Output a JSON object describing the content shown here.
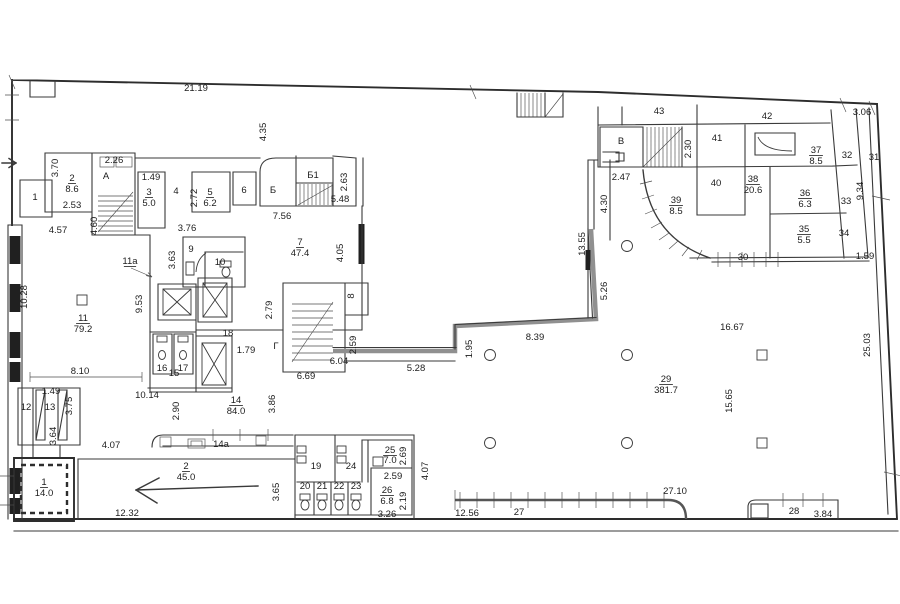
{
  "plan": {
    "type": "architectural-floor-plan",
    "background": "#ffffff",
    "line_color": "#3a3a3a",
    "thick_wall_color": "#909090",
    "labels": [
      {
        "id": "dim-21-19",
        "text": "21.19",
        "x": 196,
        "y": 91,
        "size": 11
      },
      {
        "id": "dim-4-35",
        "text": "4.35",
        "x": 266,
        "y": 132,
        "rot": -90
      },
      {
        "id": "dim-3-06",
        "text": "3.06",
        "x": 862,
        "y": 115
      },
      {
        "id": "dim-3-70",
        "text": "3.70",
        "x": 58,
        "y": 168,
        "rot": -90
      },
      {
        "id": "dim-2-26",
        "text": "2.26",
        "x": 114,
        "y": 163
      },
      {
        "id": "dim-1-49-a",
        "text": "1.49",
        "x": 151,
        "y": 180
      },
      {
        "id": "dim-2-53",
        "text": "2.53",
        "x": 72,
        "y": 208
      },
      {
        "id": "dim-4-60",
        "text": "4.60",
        "x": 97,
        "y": 226,
        "rot": -90
      },
      {
        "id": "dim-2-72",
        "text": "2.72",
        "x": 197,
        "y": 198,
        "rot": -90
      },
      {
        "id": "dim-3-76",
        "text": "3.76",
        "x": 187,
        "y": 231
      },
      {
        "id": "dim-4-57",
        "text": "4.57",
        "x": 58,
        "y": 233
      },
      {
        "id": "dim-2-63",
        "text": "2.63",
        "x": 347,
        "y": 182,
        "rot": -90
      },
      {
        "id": "dim-5-48",
        "text": "5.48",
        "x": 340,
        "y": 202
      },
      {
        "id": "dim-7-56",
        "text": "7.56",
        "x": 282,
        "y": 219
      },
      {
        "id": "dim-4-05",
        "text": "4.05",
        "x": 343,
        "y": 253,
        "rot": -90
      },
      {
        "id": "dim-3-63",
        "text": "3.63",
        "x": 175,
        "y": 260,
        "rot": -90
      },
      {
        "id": "dim-10-28",
        "text": "10.28",
        "x": 27,
        "y": 297,
        "rot": -90
      },
      {
        "id": "dim-9-53",
        "text": "9.53",
        "x": 142,
        "y": 304,
        "rot": -90
      },
      {
        "id": "dim-2-79",
        "text": "2.79",
        "x": 272,
        "y": 310,
        "rot": -90
      },
      {
        "id": "dim-1-79",
        "text": "1.79",
        "x": 246,
        "y": 353
      },
      {
        "id": "dim-2-59-a",
        "text": "2.59",
        "x": 356,
        "y": 345,
        "rot": -90
      },
      {
        "id": "dim-6-04",
        "text": "6.04",
        "x": 339,
        "y": 364
      },
      {
        "id": "dim-6-69",
        "text": "6.69",
        "x": 306,
        "y": 379
      },
      {
        "id": "dim-5-28",
        "text": "5.28",
        "x": 416,
        "y": 371
      },
      {
        "id": "dim-8-10",
        "text": "8.10",
        "x": 80,
        "y": 374
      },
      {
        "id": "dim-1-49-b",
        "text": "1.49",
        "x": 51,
        "y": 394
      },
      {
        "id": "dim-3-75",
        "text": "3.75",
        "x": 72,
        "y": 406,
        "rot": -90
      },
      {
        "id": "dim-10-14",
        "text": "10.14",
        "x": 147,
        "y": 398
      },
      {
        "id": "dim-2-90",
        "text": "2.90",
        "x": 179,
        "y": 411,
        "rot": -90
      },
      {
        "id": "dim-3-86",
        "text": "3.86",
        "x": 275,
        "y": 404,
        "rot": -90
      },
      {
        "id": "dim-3-64",
        "text": "3.64",
        "x": 56,
        "y": 436,
        "rot": -90
      },
      {
        "id": "dim-4-07-a",
        "text": "4.07",
        "x": 111,
        "y": 448
      },
      {
        "id": "dim-12-32",
        "text": "12.32",
        "x": 127,
        "y": 516
      },
      {
        "id": "dim-3-65",
        "text": "3.65",
        "x": 279,
        "y": 492,
        "rot": -90
      },
      {
        "id": "dim-2-69",
        "text": "2.69",
        "x": 406,
        "y": 456,
        "rot": -90
      },
      {
        "id": "dim-2-59-b",
        "text": "2.59",
        "x": 393,
        "y": 479
      },
      {
        "id": "dim-2-19",
        "text": "2.19",
        "x": 406,
        "y": 501,
        "rot": -90
      },
      {
        "id": "dim-3-26",
        "text": "3.26",
        "x": 387,
        "y": 517
      },
      {
        "id": "dim-4-07-b",
        "text": "4.07",
        "x": 428,
        "y": 471,
        "rot": -90
      },
      {
        "id": "dim-12-56",
        "text": "12.56",
        "x": 467,
        "y": 516
      },
      {
        "id": "dim-27-10",
        "text": "27.10",
        "x": 675,
        "y": 494
      },
      {
        "id": "dim-3-84",
        "text": "3.84",
        "x": 823,
        "y": 517
      },
      {
        "id": "dim-1-95",
        "text": "1.95",
        "x": 472,
        "y": 349,
        "rot": -90
      },
      {
        "id": "dim-8-39",
        "text": "8.39",
        "x": 535,
        "y": 340
      },
      {
        "id": "dim-5-26",
        "text": "5.26",
        "x": 607,
        "y": 291,
        "rot": -90
      },
      {
        "id": "dim-13-55",
        "text": "13.55",
        "x": 585,
        "y": 244,
        "rot": -90
      },
      {
        "id": "dim-4-30",
        "text": "4.30",
        "x": 607,
        "y": 204,
        "rot": -90
      },
      {
        "id": "dim-2-47",
        "text": "2.47",
        "x": 621,
        "y": 180
      },
      {
        "id": "dim-2-30",
        "text": "2.30",
        "x": 691,
        "y": 149,
        "rot": -90
      },
      {
        "id": "dim-9-34",
        "text": "9.34",
        "x": 863,
        "y": 191,
        "rot": -90
      },
      {
        "id": "dim-1-59",
        "text": "1.59",
        "x": 865,
        "y": 259
      },
      {
        "id": "dim-16-67",
        "text": "16.67",
        "x": 732,
        "y": 330
      },
      {
        "id": "dim-15-65",
        "text": "15.65",
        "x": 732,
        "y": 401,
        "rot": -90
      },
      {
        "id": "dim-25-03",
        "text": "25.03",
        "x": 870,
        "y": 345,
        "rot": -90
      },
      {
        "id": "room-1-top",
        "text": "1",
        "x": 35,
        "y": 200
      },
      {
        "id": "room-2-num",
        "text": "2",
        "x": 72,
        "y": 181,
        "u": true
      },
      {
        "id": "room-2-area",
        "text": "8.6",
        "x": 72,
        "y": 192
      },
      {
        "id": "stair-a",
        "text": "А",
        "x": 106,
        "y": 179,
        "size": 11
      },
      {
        "id": "room-3-num",
        "text": "3",
        "x": 149,
        "y": 195,
        "u": true
      },
      {
        "id": "room-3-area",
        "text": "5.0",
        "x": 149,
        "y": 206
      },
      {
        "id": "room-4",
        "text": "4",
        "x": 176,
        "y": 194
      },
      {
        "id": "room-5-num",
        "text": "5",
        "x": 210,
        "y": 195,
        "u": true
      },
      {
        "id": "room-5-area",
        "text": "6.2",
        "x": 210,
        "y": 206
      },
      {
        "id": "room-6",
        "text": "6",
        "x": 244,
        "y": 193
      },
      {
        "id": "stair-b",
        "text": "Б",
        "x": 273,
        "y": 193,
        "size": 11
      },
      {
        "id": "stair-b1",
        "text": "Б1",
        "x": 313,
        "y": 178
      },
      {
        "id": "room-7-num",
        "text": "7",
        "x": 300,
        "y": 245,
        "u": true
      },
      {
        "id": "room-7-area",
        "text": "47.4",
        "x": 300,
        "y": 256
      },
      {
        "id": "room-9",
        "text": "9",
        "x": 191,
        "y": 252
      },
      {
        "id": "room-10",
        "text": "10",
        "x": 220,
        "y": 265
      },
      {
        "id": "room-11-num",
        "text": "11",
        "x": 83,
        "y": 321,
        "u": true
      },
      {
        "id": "room-11-area",
        "text": "79.2",
        "x": 83,
        "y": 332
      },
      {
        "id": "room-8",
        "text": "8",
        "x": 354,
        "y": 296,
        "rot": -90,
        "size": 8
      },
      {
        "id": "room-11a",
        "text": "11а",
        "x": 130,
        "y": 264,
        "size": 5.5,
        "u": true
      },
      {
        "id": "room-12",
        "text": "12",
        "x": 26,
        "y": 410
      },
      {
        "id": "room-13",
        "text": "13",
        "x": 50,
        "y": 410
      },
      {
        "id": "room-15",
        "text": "15",
        "x": 174,
        "y": 376
      },
      {
        "id": "room-16",
        "text": "16",
        "x": 162,
        "y": 371,
        "size": 8
      },
      {
        "id": "room-17",
        "text": "17",
        "x": 183,
        "y": 371,
        "size": 8
      },
      {
        "id": "room-18",
        "text": "18",
        "x": 228,
        "y": 336
      },
      {
        "id": "stair-g",
        "text": "Г",
        "x": 276,
        "y": 349,
        "size": 11
      },
      {
        "id": "room-14-num",
        "text": "14",
        "x": 236,
        "y": 403,
        "u": true
      },
      {
        "id": "room-14-area",
        "text": "84.0",
        "x": 236,
        "y": 414
      },
      {
        "id": "room-14a",
        "text": "14а",
        "x": 221,
        "y": 447
      },
      {
        "id": "room-1b-num",
        "text": "1",
        "x": 44,
        "y": 485,
        "u": true
      },
      {
        "id": "room-1b-area",
        "text": "14.0",
        "x": 44,
        "y": 496
      },
      {
        "id": "room-2b-num",
        "text": "2",
        "x": 186,
        "y": 469,
        "u": true
      },
      {
        "id": "room-2b-area",
        "text": "45.0",
        "x": 186,
        "y": 480
      },
      {
        "id": "room-19",
        "text": "19",
        "x": 316,
        "y": 469
      },
      {
        "id": "room-24",
        "text": "24",
        "x": 351,
        "y": 469
      },
      {
        "id": "room-25-num",
        "text": "25",
        "x": 390,
        "y": 453,
        "u": true
      },
      {
        "id": "room-25-area",
        "text": "7.0",
        "x": 390,
        "y": 463
      },
      {
        "id": "room-26-num",
        "text": "26",
        "x": 387,
        "y": 493,
        "u": true
      },
      {
        "id": "room-26-area",
        "text": "6.8",
        "x": 387,
        "y": 504
      },
      {
        "id": "stall-20",
        "text": "20",
        "x": 305,
        "y": 489,
        "size": 4.5
      },
      {
        "id": "stall-21",
        "text": "21",
        "x": 322,
        "y": 489,
        "size": 4.5
      },
      {
        "id": "stall-22",
        "text": "22",
        "x": 339,
        "y": 489,
        "size": 4.5
      },
      {
        "id": "stall-23",
        "text": "23",
        "x": 356,
        "y": 489,
        "size": 4.5
      },
      {
        "id": "room-27",
        "text": "27",
        "x": 519,
        "y": 515
      },
      {
        "id": "room-28",
        "text": "28",
        "x": 794,
        "y": 514
      },
      {
        "id": "room-29-num",
        "text": "29",
        "x": 666,
        "y": 382,
        "u": true
      },
      {
        "id": "room-29-area",
        "text": "381.7",
        "x": 666,
        "y": 393
      },
      {
        "id": "room-30",
        "text": "30",
        "x": 743,
        "y": 260,
        "size": 6
      },
      {
        "id": "room-31",
        "text": "31",
        "x": 874,
        "y": 160
      },
      {
        "id": "room-32",
        "text": "32",
        "x": 847,
        "y": 158
      },
      {
        "id": "room-33",
        "text": "33",
        "x": 846,
        "y": 204
      },
      {
        "id": "room-34",
        "text": "34",
        "x": 844,
        "y": 236
      },
      {
        "id": "room-35-num",
        "text": "35",
        "x": 804,
        "y": 232,
        "u": true
      },
      {
        "id": "room-35-area",
        "text": "5.5",
        "x": 804,
        "y": 243
      },
      {
        "id": "room-36-num",
        "text": "36",
        "x": 805,
        "y": 196,
        "u": true
      },
      {
        "id": "room-36-area",
        "text": "6.3",
        "x": 805,
        "y": 207
      },
      {
        "id": "room-37-num",
        "text": "37",
        "x": 816,
        "y": 153,
        "u": true
      },
      {
        "id": "room-37-area",
        "text": "8.5",
        "x": 816,
        "y": 164
      },
      {
        "id": "room-38-num",
        "text": "38",
        "x": 753,
        "y": 182,
        "u": true
      },
      {
        "id": "room-38-area",
        "text": "20.6",
        "x": 753,
        "y": 193
      },
      {
        "id": "room-39-num",
        "text": "39",
        "x": 676,
        "y": 203,
        "u": true
      },
      {
        "id": "room-39-area",
        "text": "8.5",
        "x": 676,
        "y": 214
      },
      {
        "id": "room-40",
        "text": "40",
        "x": 716,
        "y": 186
      },
      {
        "id": "room-41",
        "text": "41",
        "x": 717,
        "y": 141
      },
      {
        "id": "room-42",
        "text": "42",
        "x": 767,
        "y": 119
      },
      {
        "id": "room-43",
        "text": "43",
        "x": 659,
        "y": 114
      },
      {
        "id": "stair-v",
        "text": "В",
        "x": 621,
        "y": 144,
        "size": 11
      }
    ]
  }
}
